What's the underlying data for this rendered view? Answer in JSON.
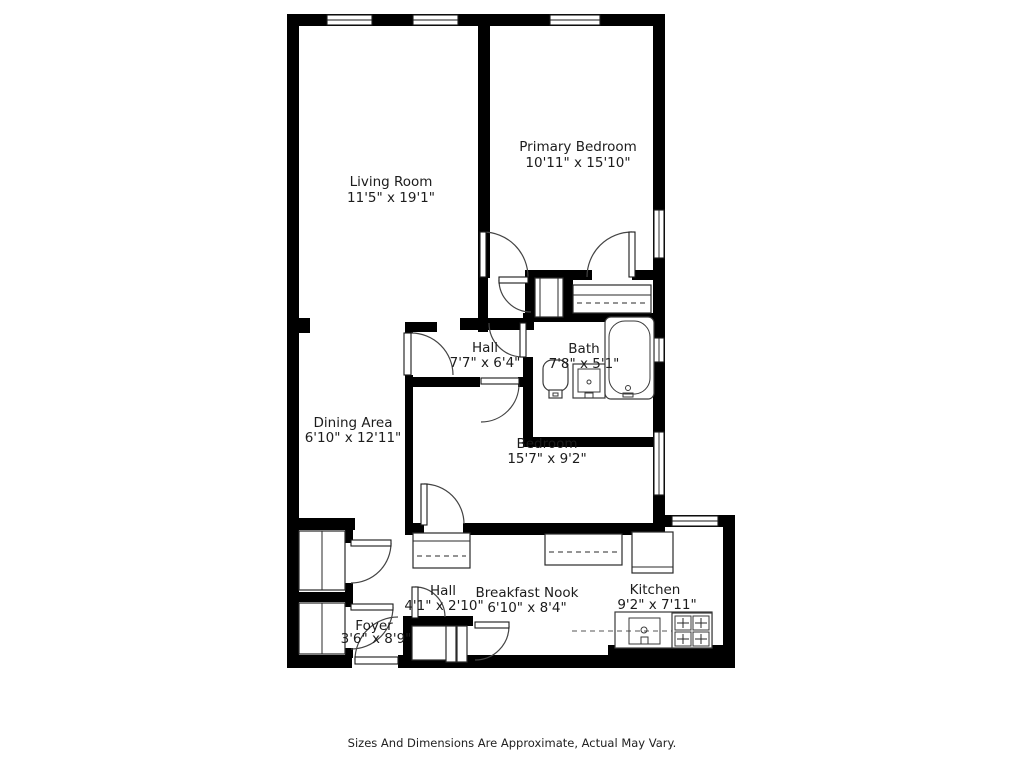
{
  "plan": {
    "rooms": {
      "living_room": {
        "name": "Living Room",
        "dims": "11'5\" x 19'1\""
      },
      "primary_bedroom": {
        "name": "Primary Bedroom",
        "dims": "10'11\" x 15'10\""
      },
      "hall_upper": {
        "name": "Hall",
        "dims": "7'7\" x 6'4\""
      },
      "bath": {
        "name": "Bath",
        "dims": "7'8\" x 5'1\""
      },
      "dining_area": {
        "name": "Dining Area",
        "dims": "6'10\" x 12'11\""
      },
      "bedroom": {
        "name": "Bedroom",
        "dims": "15'7\" x 9'2\""
      },
      "hall_lower": {
        "name": "Hall",
        "dims": "4'1\" x 2'10\""
      },
      "breakfast_nook": {
        "name": "Breakfast Nook",
        "dims": "6'10\" x 8'4\""
      },
      "kitchen": {
        "name": "Kitchen",
        "dims": "9'2\" x 7'11\""
      },
      "foyer": {
        "name": "Foyer",
        "dims": "3'6\" x 8'9\""
      }
    },
    "footer": "Sizes And Dimensions Are Approximate, Actual May Vary.",
    "colors": {
      "wall": "#000000",
      "text": "#1c1c1c",
      "background": "#ffffff"
    }
  }
}
